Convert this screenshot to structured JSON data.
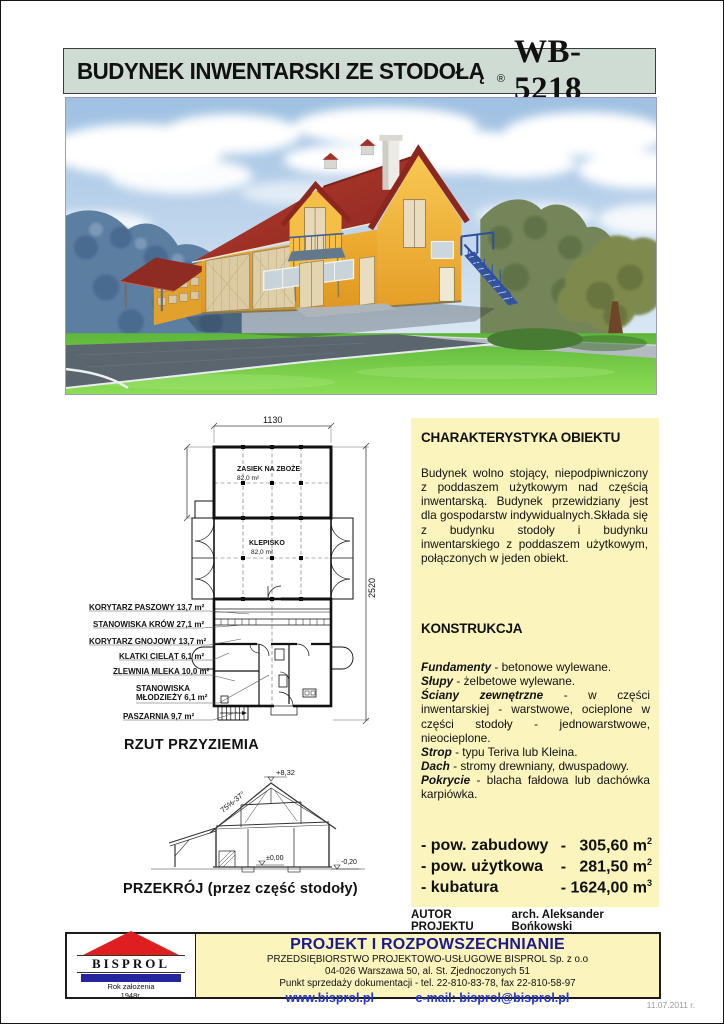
{
  "header": {
    "title": "BUDYNEK INWENTARSKI ZE STODOŁĄ",
    "reg": "®",
    "model": "WB-5218"
  },
  "plan": {
    "caption": "RZUT PRZYZIEMIA",
    "dim_top": "1130",
    "dim_right": "2520",
    "zasiek": {
      "name": "ZASIEK NA ZBOŻE",
      "area": "82,0 m²"
    },
    "klepisko": {
      "name": "KLEPISKO",
      "area": "82,0 m²"
    },
    "labels": [
      "KORYTARZ PASZOWY 13,7 m²",
      "STANOWISKA KRÓW 27,1 m²",
      "KORYTARZ GNOJOWY 13,7 m²",
      "KLATKI CIELĄT 6,1 m²",
      "ZLEWNIA MLEKA 10,0 m²",
      "STANOWISKA MŁODZIEŻY 6,1 m²",
      "PASZARNIA 9,7 m²"
    ]
  },
  "section": {
    "caption": "PRZEKRÓJ (przez część stodoły)",
    "level_ridge": "+8,32",
    "slope": "75%-37°",
    "level_zero": "±0,00",
    "level_base": "-0,20"
  },
  "charakterystyka": {
    "heading": "CHARAKTERYSTYKA OBIEKTU",
    "body": "Budynek wolno stojący, niepodpiwniczony z poddaszem użytkowym nad częścią inwentarską. Budynek przewidziany jest dla gospodarstw indywidualnych.Składa się z budynku stodoły i budynku inwentarskiego z poddaszem użytkowym, połączonych w jeden obiekt."
  },
  "konstrukcja": {
    "heading": "KONSTRUKCJA",
    "items": [
      {
        "term": "Fundamenty",
        "desc": " - betonowe wylewane."
      },
      {
        "term": "Słupy",
        "desc": " - żelbetowe wylewane."
      },
      {
        "term": "Ściany zewnętrzne",
        "desc": " - w części inwentarskiej - warstwowe, ocieplone w części stodoły - jednowarstwowe, nieocieplone."
      },
      {
        "term": "Strop",
        "desc": " - typu Teriva lub Kleina."
      },
      {
        "term": "Dach",
        "desc": " - stromy drewniany, dwuspadowy."
      },
      {
        "term": "Pokrycie",
        "desc": " - blacha fałdowa lub dachówka karpiówka."
      }
    ]
  },
  "stats": [
    {
      "label": "- pow. zabudowy",
      "value": "-   305,60 m",
      "sup": "2"
    },
    {
      "label": "- pow. użytkowa",
      "value": "-   281,50 m",
      "sup": "2"
    },
    {
      "label": "- kubatura",
      "value": "- 1624,00 m",
      "sup": "3"
    }
  ],
  "author": {
    "label": "AUTOR PROJEKTU",
    "name": "arch. Aleksander Bońkowski"
  },
  "footer": {
    "logo": {
      "name": "BISPROL",
      "line1": "Rok założenia",
      "line2": "1948r."
    },
    "title": "PROJEKT I ROZPOWSZECHNIANIE",
    "company": "PRZEDSIĘBIORSTWO PROJEKTOWO-USŁUGOWE BISPROL Sp. z o.o",
    "address": "04-026 Warszawa 50, al. St. Zjednoczonych 51",
    "sales": "Punkt sprzedaży dokumentacji - tel. 22-810-83-78, fax 22-810-58-97",
    "web": "www.bisprol.pl",
    "email": "e-mail: bisprol@bisprol.pl"
  },
  "date": "11.07.2011 r.",
  "colors": {
    "header_bg": "#cfdcd4",
    "panel_yellow": "#fcf4bd",
    "navy": "#1b1b8e",
    "link_blue": "#2333cc",
    "roof_red": "#a23028",
    "wall_yellow": "#f0ae35"
  }
}
